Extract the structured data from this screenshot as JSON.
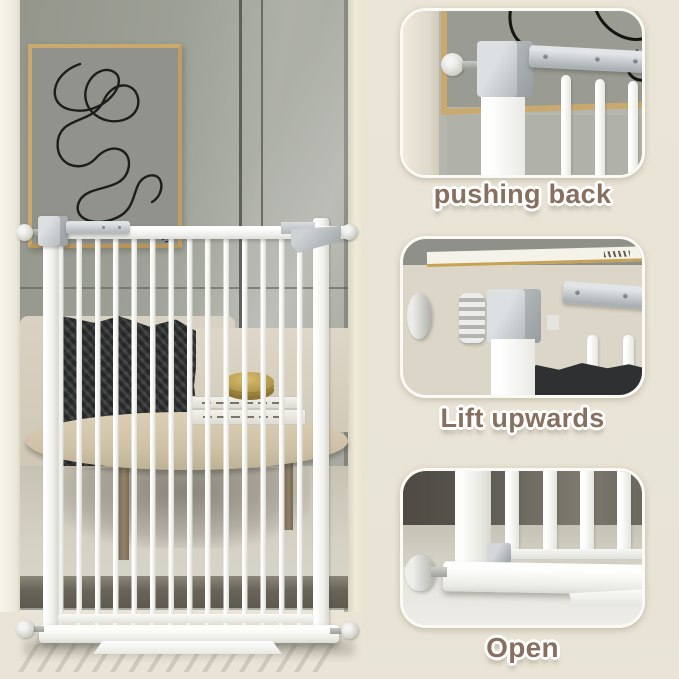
{
  "colors": {
    "background": "#e9e4d6",
    "label_text": "#87705f",
    "label_outline": "#ffffff",
    "gate_white": "#f6f6f3",
    "hardware_gray": "#c2c6c9",
    "wall_gray": "#a0a298",
    "frame_tan": "#c9a96e"
  },
  "steps": {
    "panels": [
      {
        "id": "pushing-back",
        "label": "pushing back"
      },
      {
        "id": "lift-upwards",
        "label": "Lift upwards"
      },
      {
        "id": "open",
        "label": "Open"
      }
    ]
  }
}
